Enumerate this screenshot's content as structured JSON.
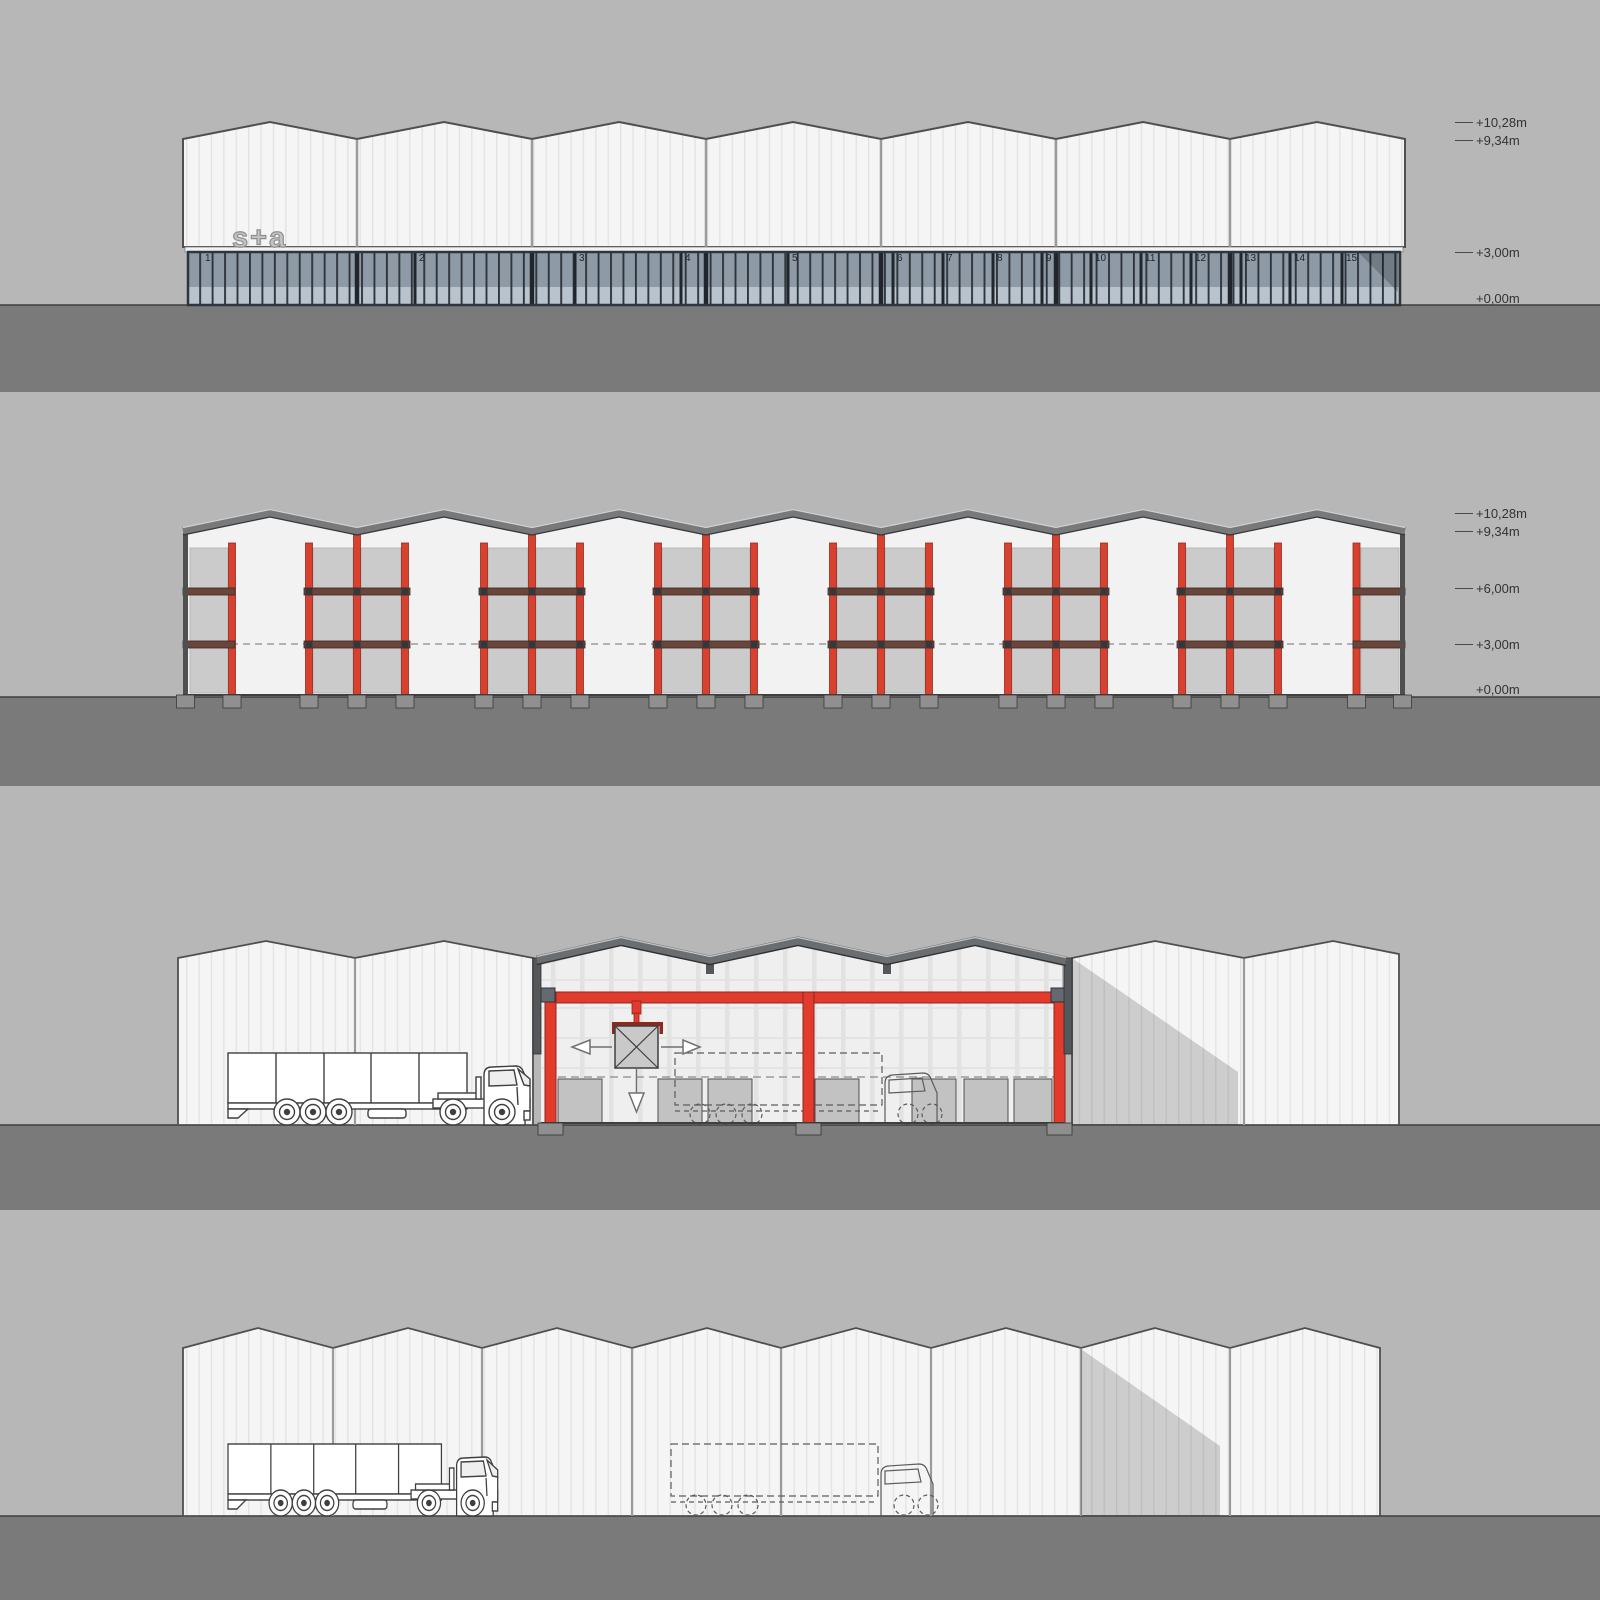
{
  "drawing_title": "industrial warehouse elevations and sections",
  "colors": {
    "background": "#b7b7b7",
    "ground": "#7a7a7a",
    "cladding_white": "#f5f5f5",
    "cladding_stripe": "#e2e2e2",
    "outline_dark": "#4f4f4f",
    "glass_upper": "#8e9aa6",
    "glass_lower": "#b9c3cd",
    "glass_frame": "#2f353d",
    "structure_red": "#d8402f",
    "beam_maroon": "#6a453c",
    "roof_gray": "#77797b",
    "panel_gray": "#cbcbcb",
    "shadow": "rgba(0,0,0,0.16)"
  },
  "elevation_front": {
    "logo": "s+a",
    "unit_numbers": [
      "1",
      "2",
      "3",
      "4",
      "5",
      "6",
      "7",
      "8",
      "9",
      "10",
      "11",
      "12",
      "13",
      "14",
      "15"
    ],
    "levels": [
      "+10,28m",
      "+9,34m",
      "+3,00m",
      "+0,00m"
    ]
  },
  "section_longitudinal": {
    "levels": [
      "+10,28m",
      "+9,34m",
      "+6,00m",
      "+3,00m",
      "+0,00m"
    ]
  }
}
